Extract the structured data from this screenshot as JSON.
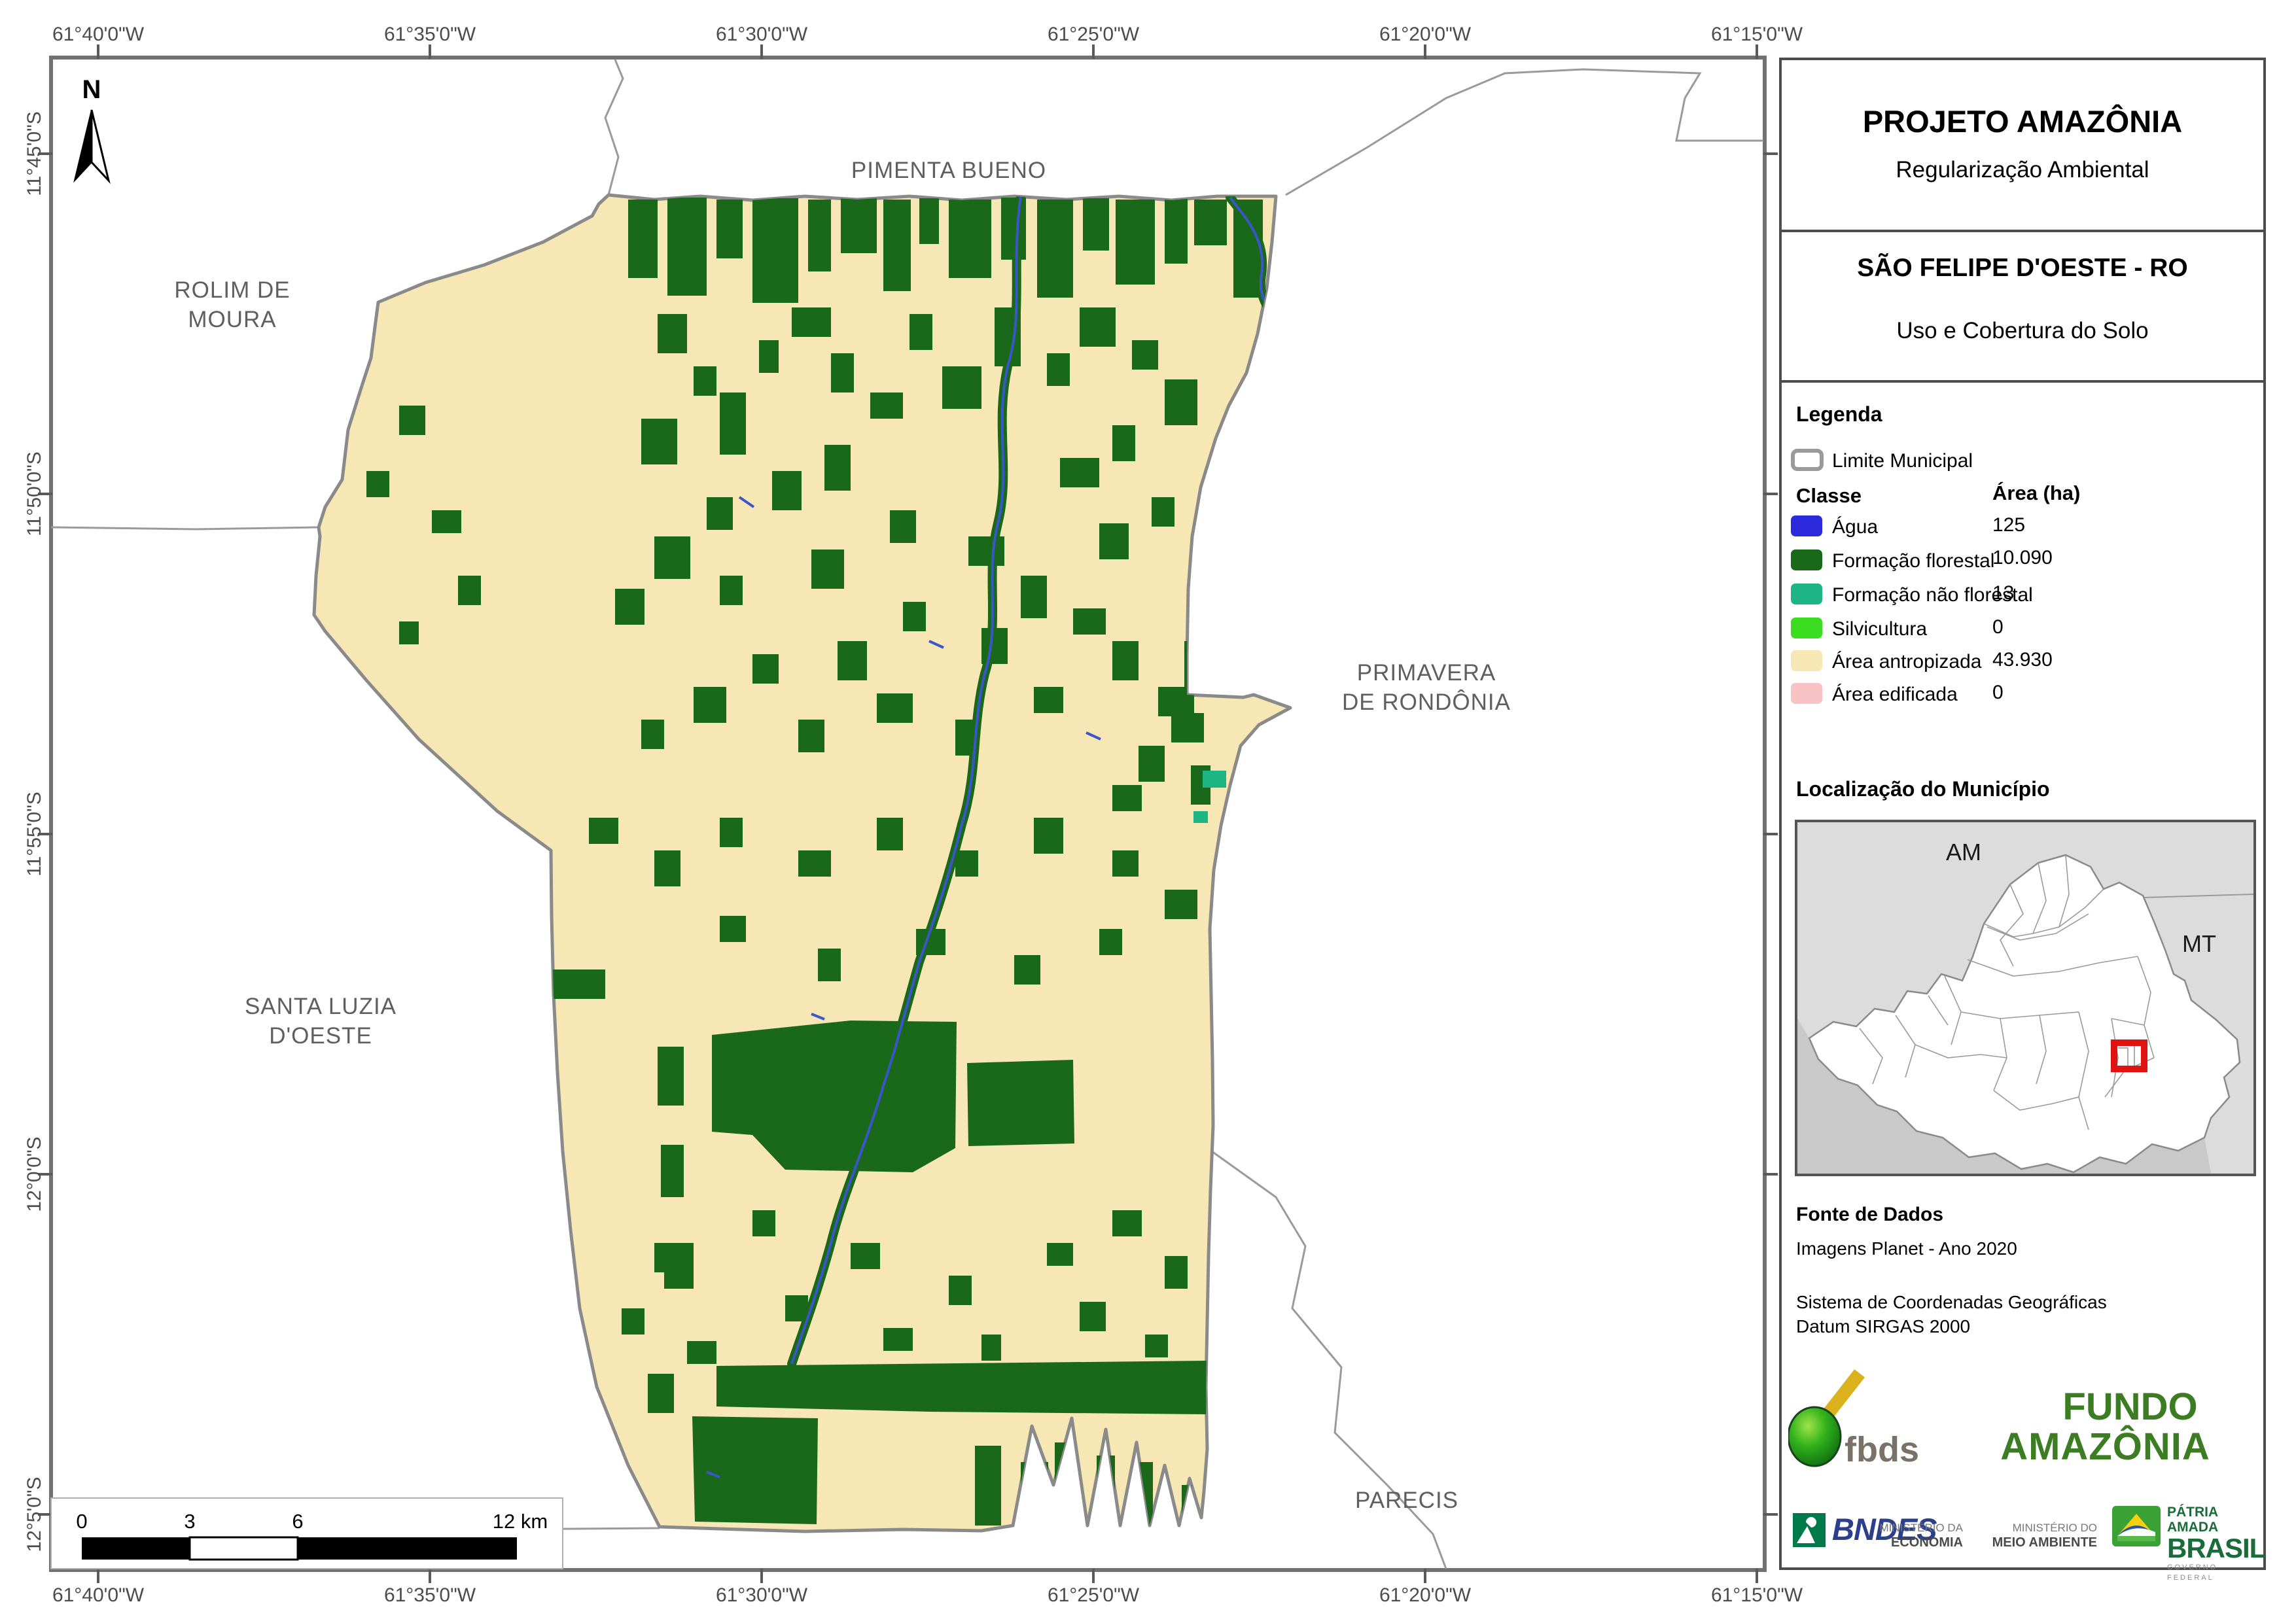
{
  "map": {
    "grid": {
      "lon_labels": [
        "61°40'0\"W",
        "61°35'0\"W",
        "61°30'0\"W",
        "61°25'0\"W",
        "61°20'0\"W",
        "61°15'0\"W"
      ],
      "lat_labels": [
        "11°45'0\"S",
        "11°50'0\"S",
        "11°55'0\"S",
        "12°0'0\"S",
        "12°5'0\"S"
      ]
    },
    "north_label": "N",
    "neighbors": {
      "pimenta": "PIMENTA BUENO",
      "rolim1": "ROLIM DE",
      "rolim2": "MOURA",
      "primavera1": "PRIMAVERA",
      "primavera2": "DE RONDÔNIA",
      "santa1": "SANTA LUZIA",
      "santa2": "D'OESTE",
      "parecis": "PARECIS"
    },
    "scale_bar": {
      "t0": "0",
      "t3": "3",
      "t6": "6",
      "t12": "12 km"
    }
  },
  "panel": {
    "title": "PROJETO AMAZÔNIA",
    "subtitle": "Regularização Ambiental",
    "municipality": "SÃO FELIPE D'OESTE - RO",
    "map_theme": "Uso e Cobertura do Solo",
    "legend": {
      "heading": "Legenda",
      "limite": "Limite Municipal",
      "col_class": "Classe",
      "col_area": "Área (ha)",
      "classes": [
        {
          "label": "Água",
          "area": "125",
          "color": "#2b2bdd"
        },
        {
          "label": "Formação florestal",
          "area": "10.090",
          "color": "#1a691b"
        },
        {
          "label": "Formação não florestal",
          "area": "13",
          "color": "#1db584"
        },
        {
          "label": "Silvicultura",
          "area": "0",
          "color": "#3add20"
        },
        {
          "label": "Área antropizada",
          "area": "43.930",
          "color": "#f6e7b4"
        },
        {
          "label": "Área edificada",
          "area": "0",
          "color": "#f9c2c4"
        }
      ]
    },
    "location": {
      "heading": "Localização do Município",
      "am": "AM",
      "mt": "MT"
    },
    "source": {
      "heading": "Fonte de Dados",
      "line1": "Imagens Planet - Ano 2020",
      "line2": "Sistema de Coordenadas Geográficas",
      "line3": "Datum SIRGAS 2000"
    },
    "logos": {
      "fbds": "fbds",
      "fundo1": "FUNDO",
      "fundo2": "AMAZÔNIA",
      "bndes": "BNDES",
      "min1a": "MINISTÉRIO DA",
      "min1b": "ECONOMIA",
      "min2a": "MINISTÉRIO DO",
      "min2b": "MEIO AMBIENTE",
      "patria1": "PÁTRIA AMADA",
      "patria2": "BRASIL",
      "patria3": "GOVERNO FEDERAL"
    }
  }
}
